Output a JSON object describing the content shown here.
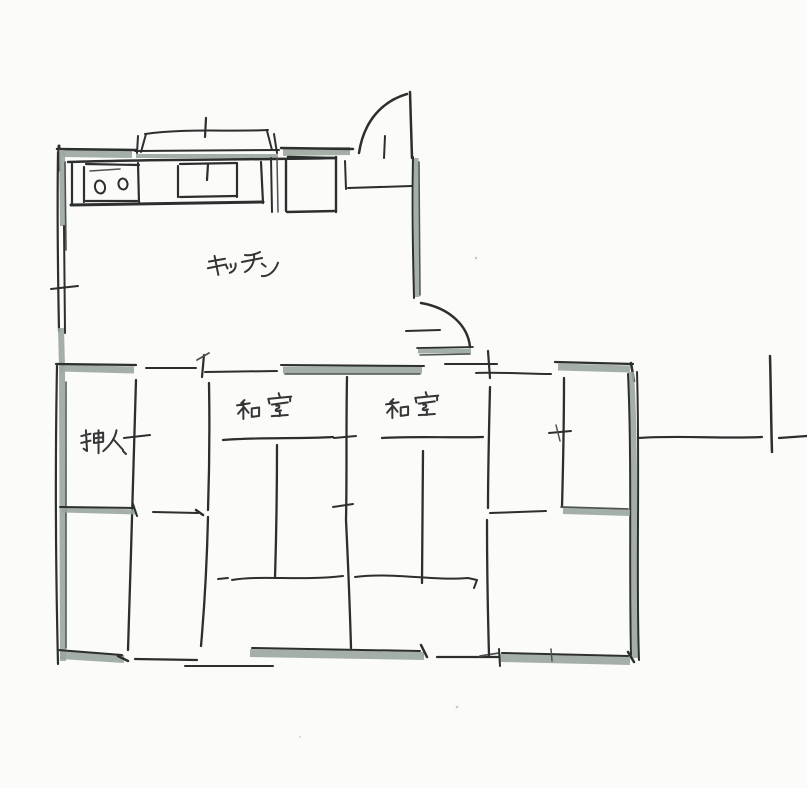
{
  "document": {
    "kind": "hand-drawn floor plan sketch",
    "orientation": "kitchen at top-left, tatami rooms below"
  },
  "palette": {
    "paper": "#fbfbf9",
    "ink": "#2d2f2e",
    "wall_marker_fill": "#9aa69e"
  },
  "rooms": {
    "kitchen": {
      "label": "キッチン"
    },
    "washitsu_1": {
      "label": "和室"
    },
    "washitsu_2": {
      "label": "和室"
    },
    "closet": {
      "label": "押入"
    }
  },
  "fixtures": {
    "stove": {
      "icon": "two-burner-stove-icon",
      "burners": 2
    },
    "sink": {
      "icon": "kitchen-sink-icon"
    },
    "appliance": {
      "icon": "appliance-square-icon"
    },
    "window": {
      "icon": "kitchen-window-icon"
    },
    "door_top": {
      "icon": "swing-door-icon",
      "type": "swing"
    },
    "door_hall": {
      "icon": "swing-door-icon",
      "type": "swing"
    }
  }
}
